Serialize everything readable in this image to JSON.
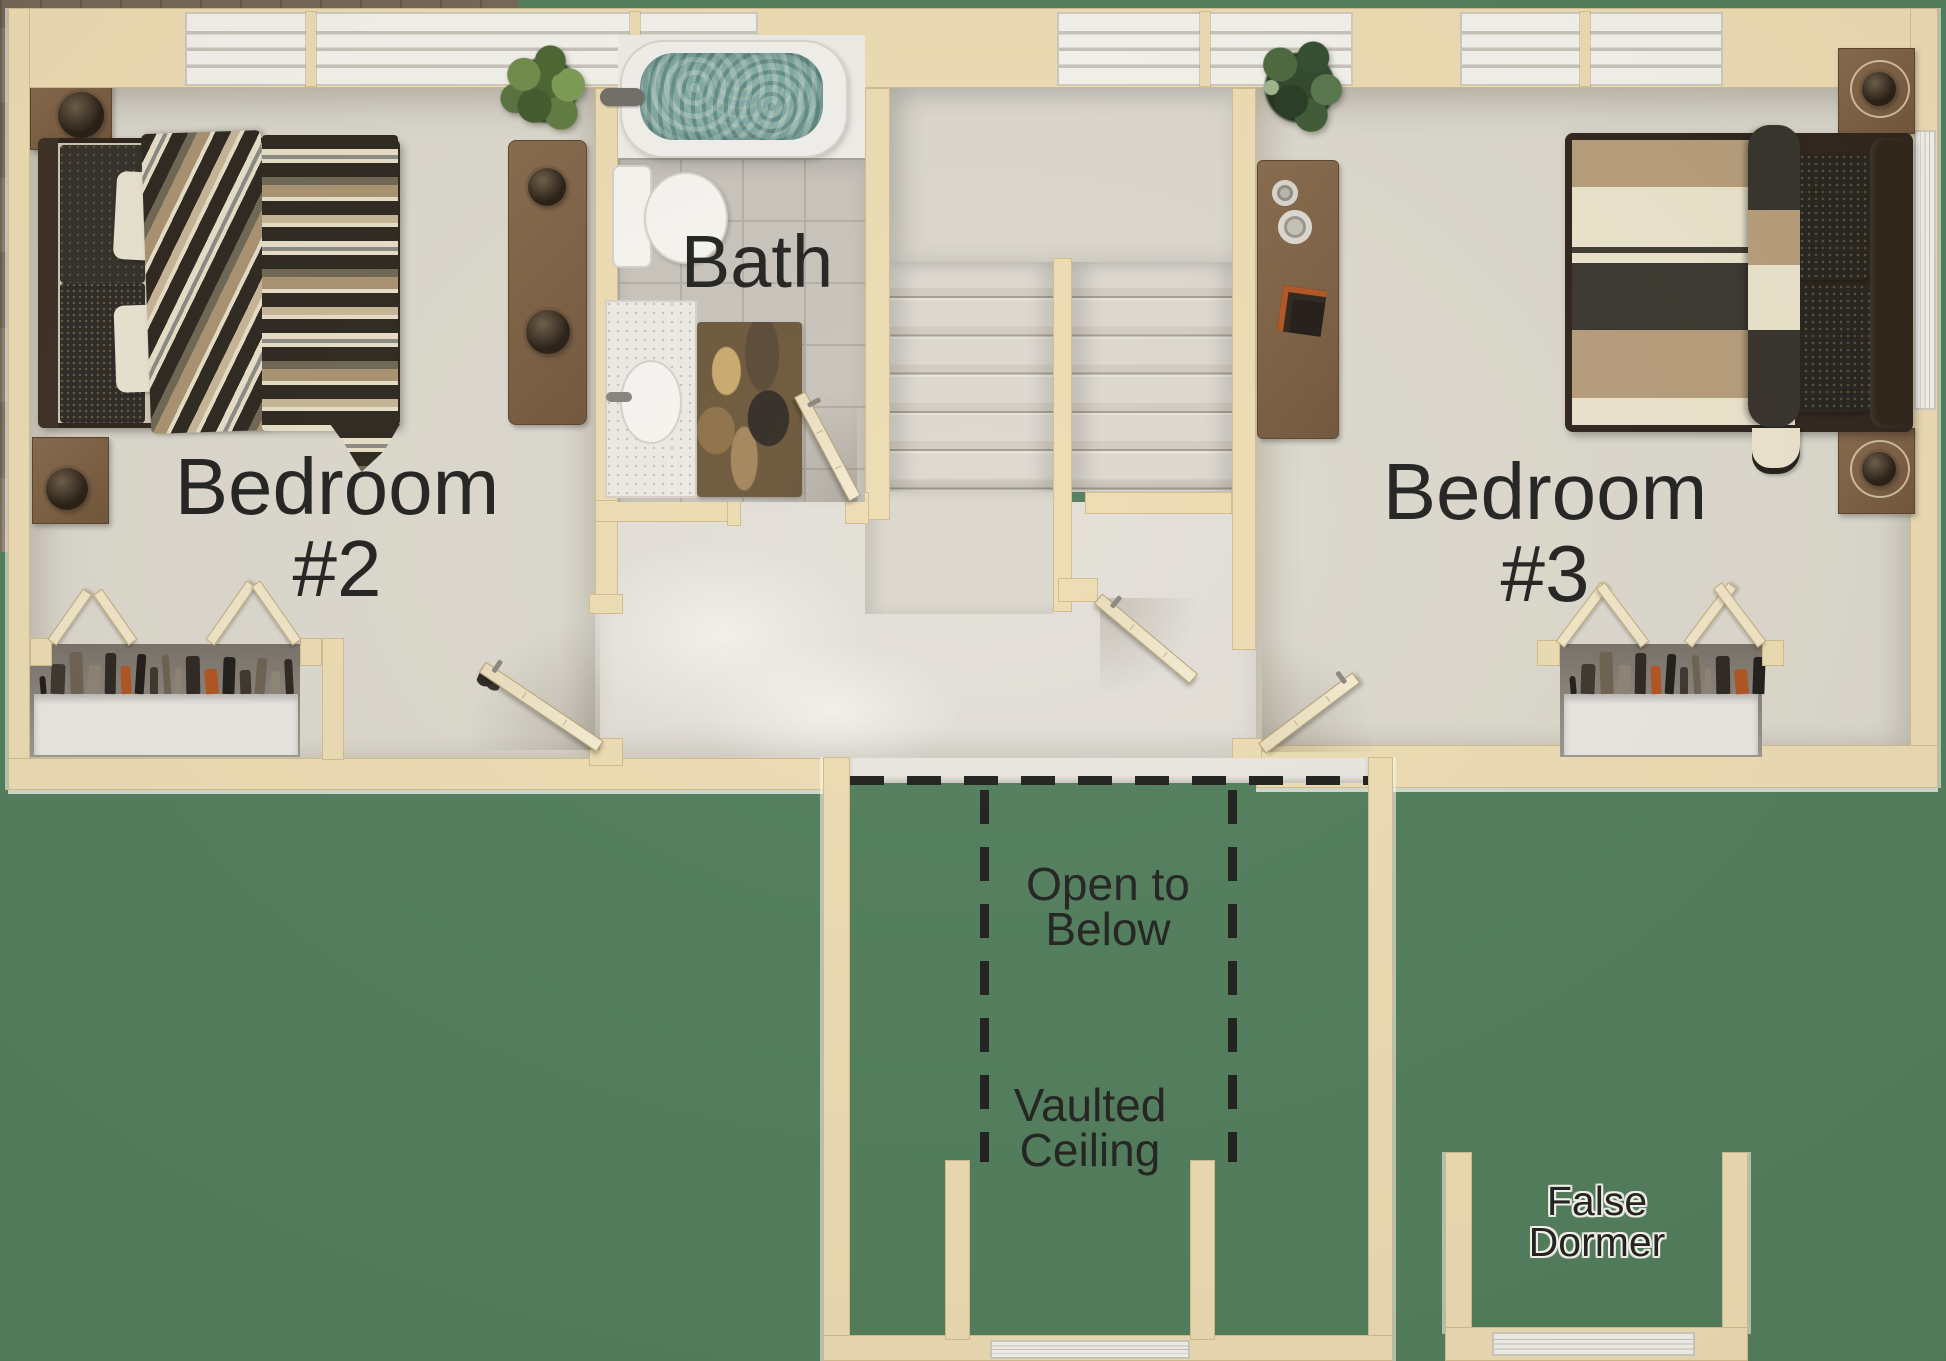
{
  "page": {
    "kind": "architectural-floor-plan-rendering",
    "view": "top-down-3d"
  },
  "colors": {
    "background": "#4f7c59",
    "wall": "#eddcb2",
    "carpet": "#dcd8cc",
    "wood_floor": "#897863",
    "water": "#7fa9a3",
    "label_text": "#1f1f1d"
  },
  "labels": {
    "bedroom2": {
      "line1": "Bedroom",
      "line2": "#2"
    },
    "bedroom3": {
      "line1": "Bedroom",
      "line2": "#3"
    },
    "bath": {
      "text": "Bath"
    },
    "open_to_below": {
      "line1": "Open to",
      "line2": "Below"
    },
    "vaulted_ceiling": {
      "line1": "Vaulted",
      "line2": "Ceiling"
    },
    "false_dormer": {
      "line1": "False",
      "line2": "Dormer"
    }
  },
  "rooms": [
    {
      "name": "Bedroom #2",
      "furniture": [
        "bed",
        "nightstand",
        "nightstand",
        "dresser",
        "plant",
        "bifold-closet",
        "door"
      ]
    },
    {
      "name": "Bath",
      "furniture": [
        "bathtub",
        "toilet",
        "vanity-sink",
        "rug",
        "door"
      ]
    },
    {
      "name": "Hallway",
      "furniture": [
        "u-shaped-staircase",
        "door"
      ]
    },
    {
      "name": "Bedroom #3",
      "furniture": [
        "bed",
        "nightstand",
        "nightstand",
        "dresser",
        "plant",
        "bifold-closet",
        "door"
      ]
    }
  ],
  "features": [
    "open-to-below-balcony",
    "vaulted-ceiling",
    "false-dormer",
    "windows",
    "dashed-ceiling-break-lines"
  ]
}
